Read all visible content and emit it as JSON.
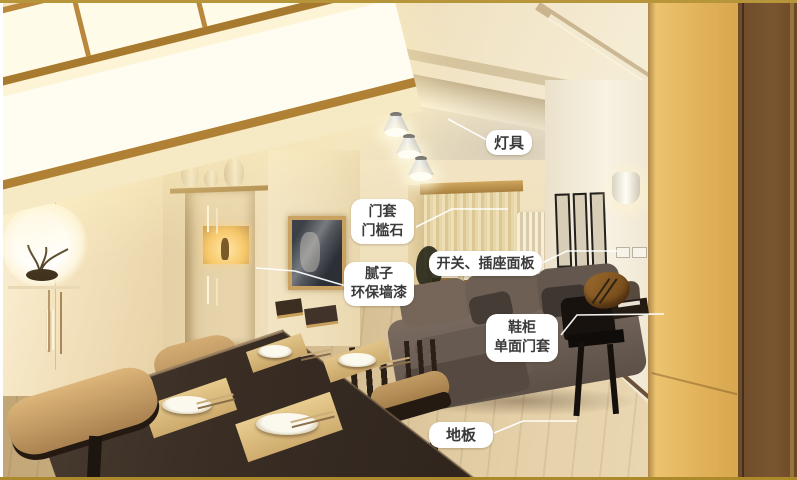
{
  "annotations": {
    "lighting": {
      "label": "灯具"
    },
    "door_casing": {
      "lines": [
        "门套",
        "门槛石"
      ]
    },
    "switch_panel": {
      "label": "开关、插座面板"
    },
    "wall_paint": {
      "lines": [
        "腻子",
        "环保墙漆"
      ]
    },
    "shoe_cabinet": {
      "lines": [
        "鞋柜",
        "单面门套"
      ]
    },
    "floor": {
      "label": "地板"
    }
  },
  "colors": {
    "label_bg": "#ffffff",
    "label_text": "#3a3a3a",
    "leader_line": "#ffffff",
    "frame_top_gold": "#b7953b",
    "frame_bottom_gold": "#ac8a2c",
    "frame_left_white": "#ffffff",
    "wood_cabinet_light": "#e2b766",
    "wood_cabinet_dark": "#6d4b2b",
    "wall_cream": "#efe0bc",
    "floor_wood": "#dcc59a",
    "table_dark": "#3b2f26"
  }
}
